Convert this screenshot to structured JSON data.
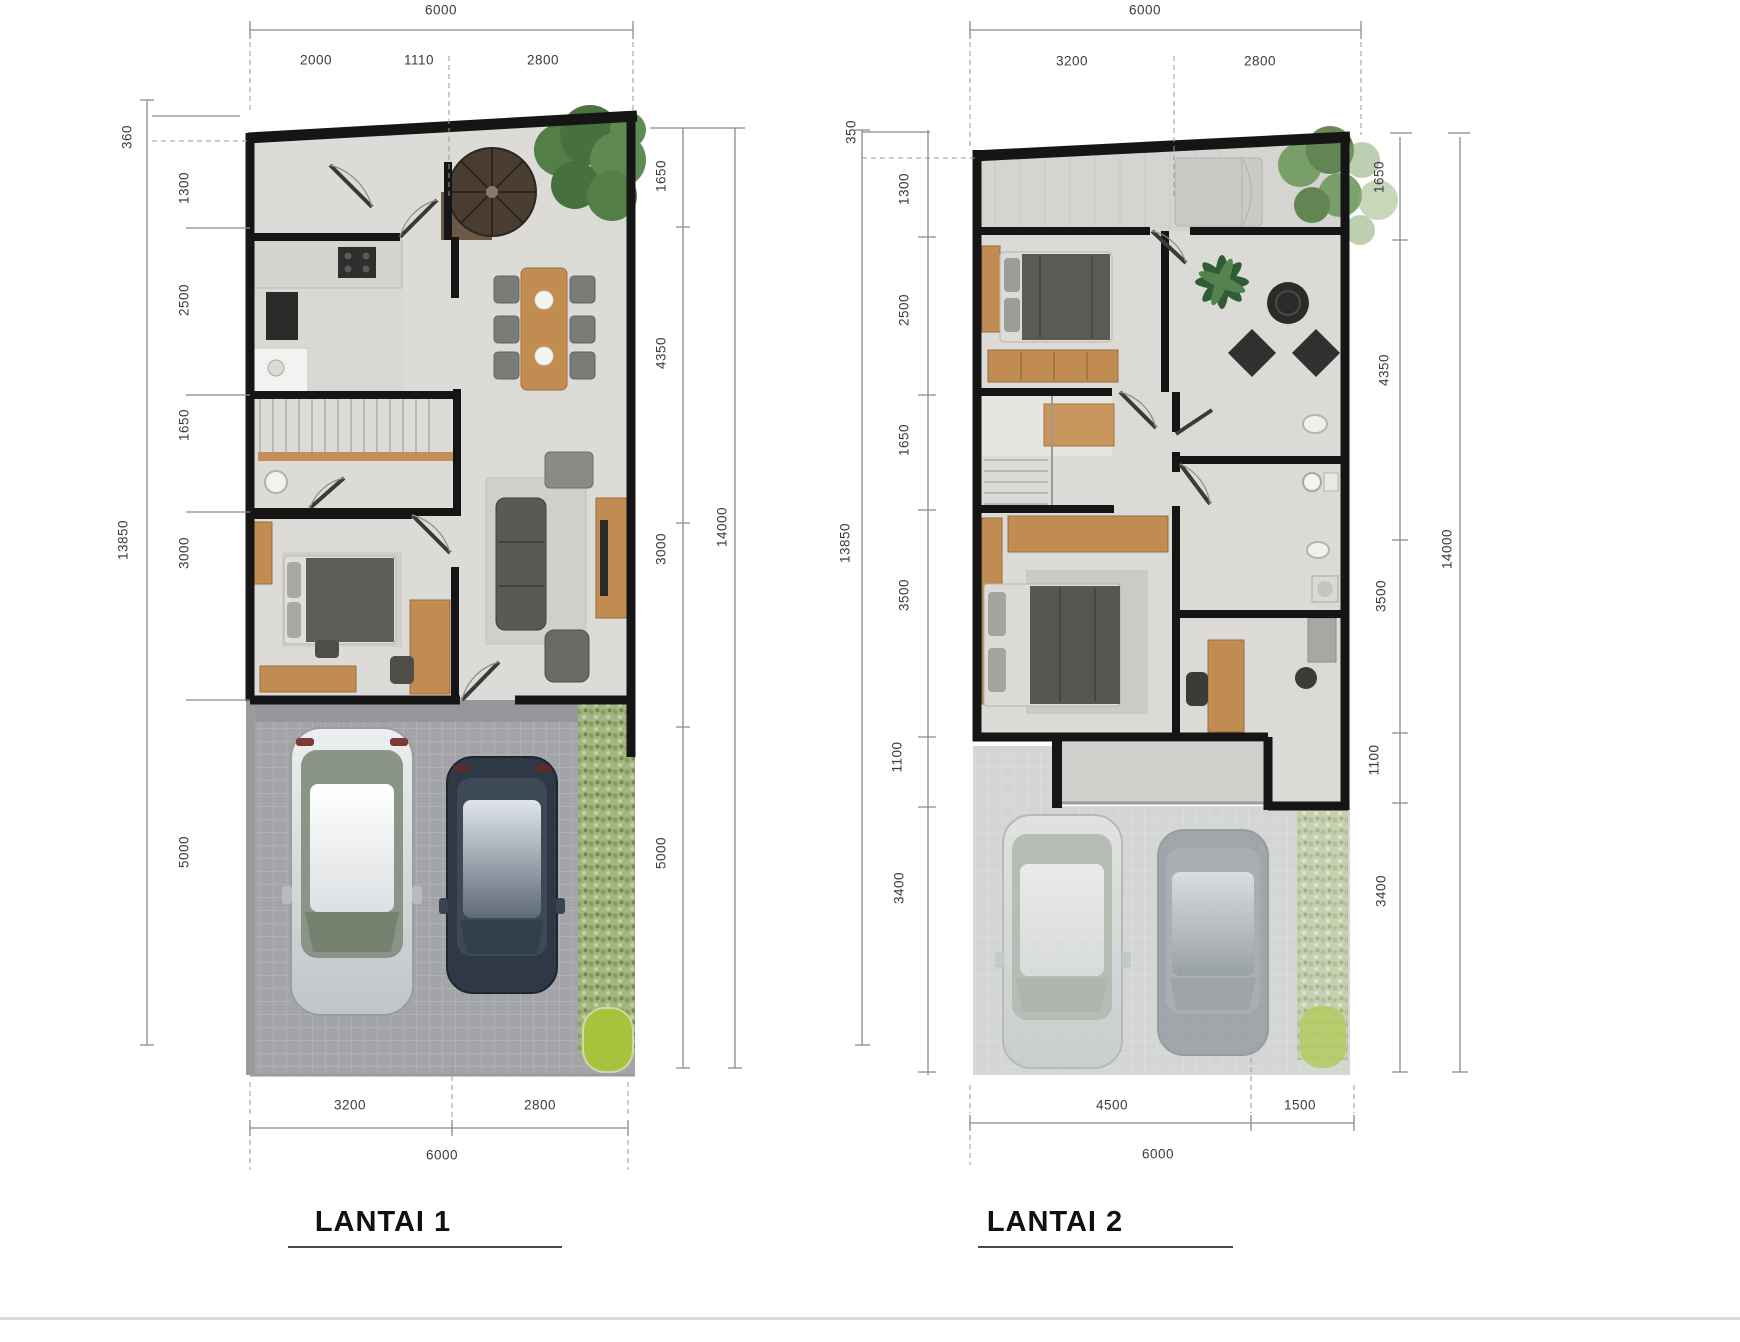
{
  "plans": [
    {
      "title": "LANTAI 1",
      "dims": {
        "top_total": "6000",
        "top_segments": [
          "2000",
          "1110",
          "2800"
        ],
        "left_total": "13850",
        "left_segments": [
          "360",
          "1300",
          "2500",
          "1650",
          "3000",
          "5000"
        ],
        "right_segments": [
          "1650",
          "4350",
          "3000",
          "5000"
        ],
        "right_total": "14000",
        "bottom_segments": [
          "3200",
          "2800"
        ],
        "bottom_total": "6000"
      }
    },
    {
      "title": "LANTAI 2",
      "dims": {
        "top_total": "6000",
        "top_segments": [
          "3200",
          "2800"
        ],
        "left_total": "13850",
        "left_segments": [
          "350",
          "1300",
          "2500",
          "1650",
          "3500",
          "1100",
          "3400"
        ],
        "right_segments": [
          "1650",
          "4350",
          "3500",
          "1100",
          "3400"
        ],
        "right_total": "14000",
        "bottom_segments": [
          "4500",
          "1500"
        ],
        "bottom_total": "6000"
      }
    }
  ],
  "colors": {
    "wall": "#151515",
    "wood": "#c08c52",
    "floor": "#dcdbd7",
    "paver": "#a2a4a7",
    "hedge": "#9db07c",
    "lime_shrub": "#a9c23e",
    "foliage": "#4c7a40",
    "dim_line": "#8a8a8a",
    "dim_text": "#3b3b3b"
  }
}
